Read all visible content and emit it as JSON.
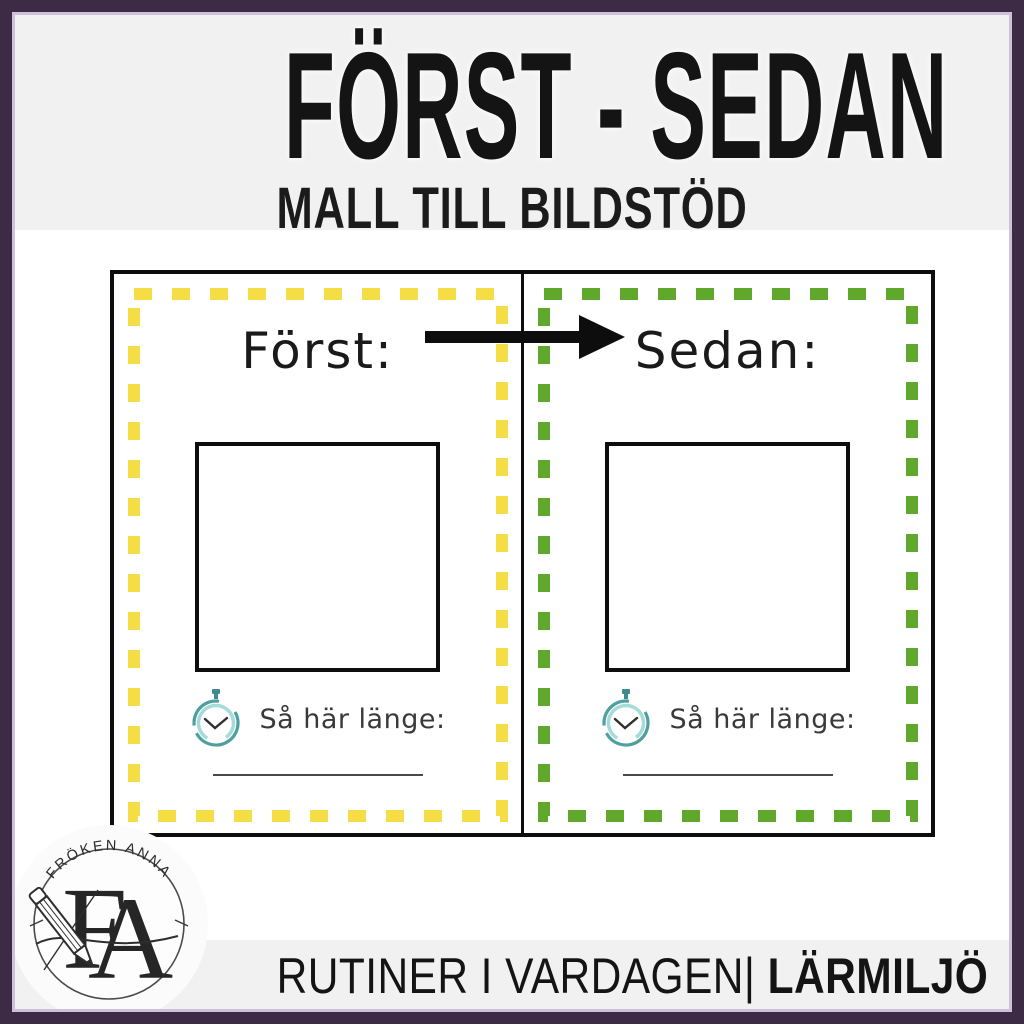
{
  "header": {
    "title": "FÖRST - SEDAN",
    "subtitle": "MALL TILL BILDSTÖD"
  },
  "worksheet": {
    "arrow_icon": "right-arrow",
    "panels": [
      {
        "label": "Först:",
        "duration_label": "Så här länge:",
        "accent_color": "#F5DE45"
      },
      {
        "label": "Sedan:",
        "duration_label": "Så här länge:",
        "accent_color": "#5FA82C"
      }
    ]
  },
  "footer": {
    "series_label": "RUTINER I VARDAGEN|",
    "category_label": "LÄRMILJÖ"
  },
  "logo": {
    "brand_name": "FRÖKEN ANNA",
    "monogram_first": "F",
    "monogram_second": "A"
  },
  "colors": {
    "frame_purple": "#3D2A45",
    "frame_inner_line": "#CEC1D8",
    "band_background": "#F2F1F2",
    "first_accent_yellow": "#F5DE45",
    "then_accent_green": "#5FA82C",
    "clock_teal_dark": "#4F9FA0",
    "clock_teal_light": "#A5DBD8"
  }
}
